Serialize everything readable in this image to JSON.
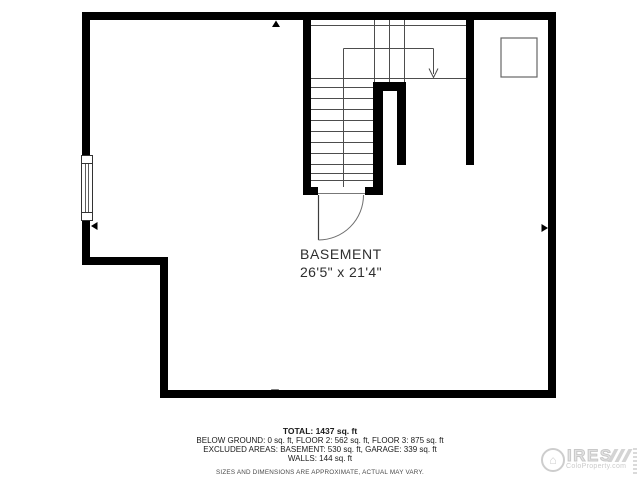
{
  "room": {
    "label": "BASEMENT",
    "dimensions": "26'5\" x 21'4\""
  },
  "summary": {
    "total": "TOTAL: 1437 sq. ft",
    "floors": "BELOW GROUND: 0 sq. ft, FLOOR 2: 562 sq. ft, FLOOR 3: 875 sq. ft",
    "excluded": "EXCLUDED AREAS: BASEMENT: 530 sq. ft, GARAGE: 339 sq. ft",
    "walls": "WALLS: 144 sq. ft",
    "disclaimer": "SIZES AND DIMENSIONS ARE APPROXIMATE, ACTUAL MAY VARY."
  },
  "watermark": {
    "brand": "IRES",
    "site": "ColoProperty.com",
    "logo_icon": "house-icon"
  },
  "colors": {
    "wall": "#000000",
    "thin_line": "#4d4d4d",
    "door_arc": "#6e6e6e",
    "text": "#1a1a1a",
    "watermark": "#cfcfcf",
    "background": "#ffffff"
  }
}
